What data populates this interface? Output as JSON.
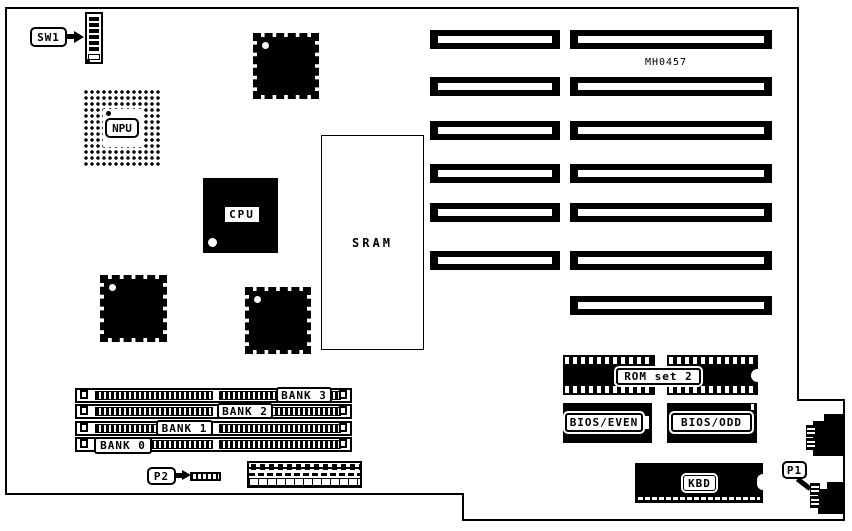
{
  "diagram": {
    "type": "motherboard-layout",
    "part_number": "MH0457",
    "colors": {
      "line": "#000000",
      "background": "#ffffff"
    },
    "labels": {
      "sw1": "SW1",
      "npu": "NPU",
      "cpu": "CPU",
      "sram": "SRAM",
      "rom_set": "ROM set 2",
      "bios_even": "BIOS/EVEN",
      "bios_odd": "BIOS/ODD",
      "kbd": "KBD",
      "p1": "P1",
      "p2": "P2"
    },
    "memory_banks": [
      {
        "label": "BANK 3"
      },
      {
        "label": "BANK 2"
      },
      {
        "label": "BANK 1"
      },
      {
        "label": "BANK 0"
      }
    ],
    "expansion_slots": {
      "left_column_count": 6,
      "right_column_count": 7
    }
  }
}
